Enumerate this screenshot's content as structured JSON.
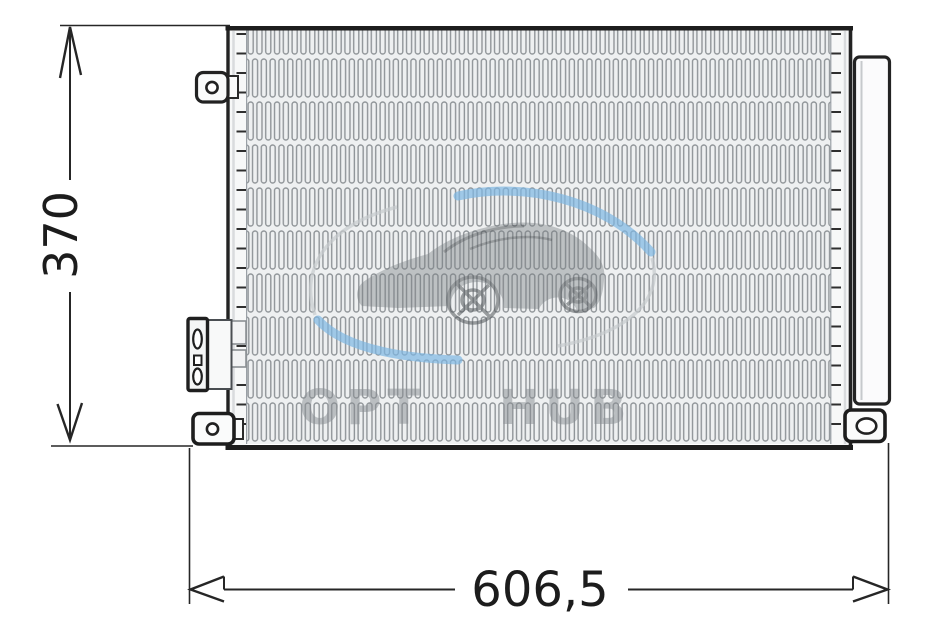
{
  "drawing": {
    "dimensions": {
      "height": "370",
      "width": "606,5"
    },
    "watermark": {
      "text": "OPT HUB"
    },
    "colors": {
      "line": "#262626",
      "fin": "#8f9498",
      "fin_background": "#eef0f1",
      "watermark_blue": "#7db6e2",
      "watermark_gray": "#c6cacd"
    }
  }
}
